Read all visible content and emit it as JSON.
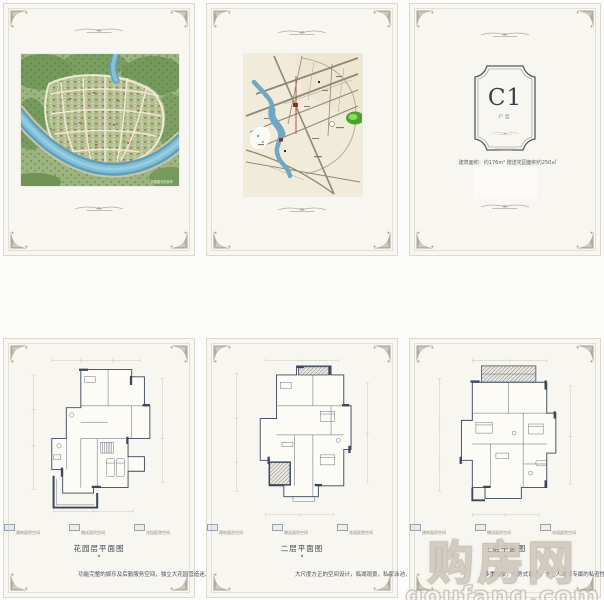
{
  "unit_card": {
    "code": "C1",
    "type_label": "户型",
    "area_info": "建筑面积：约176m² 赠送花园面积约250㎡"
  },
  "aerial": {
    "caption": "效果图仅供参考"
  },
  "plans": [
    {
      "title": "花园层平面图",
      "description": "功能完整的娱乐及后勤服务空间，独立大花园营造迷人空间。",
      "legend": [
        {
          "label": "建筑面积空间"
        },
        {
          "label": "赠送面积空间"
        },
        {
          "label": "花园庭院空间"
        }
      ]
    },
    {
      "title": "二层平面图",
      "description": "大尺度方正的空间设计，临湖观景，私家泳池，构成丰富公共活动场所。",
      "legend": [
        {
          "label": "建筑面积空间"
        },
        {
          "label": "赠送面积空间"
        },
        {
          "label": "花园庭院空间"
        }
      ]
    },
    {
      "title": "三层平面图",
      "description": "多重观景，套房式设计，令主人尽享专属的私密性和尊贵感。",
      "legend": [
        {
          "label": "建筑面积空间"
        },
        {
          "label": "赠送面积空间"
        },
        {
          "label": "花园庭院空间"
        }
      ]
    }
  ],
  "watermark": {
    "cn": "购房网",
    "en": "goufang.com"
  },
  "colors": {
    "panel_bg": "#f8f6f0",
    "frame_line": "#dcd8cc",
    "ornament_gray": "#a8a396",
    "plan_ink": "#3a4659",
    "river_blue": "#5d9fbc",
    "map_bg": "#f1ebd9",
    "park_green": "#48a238",
    "accent_red": "#b5524a",
    "watermark_fill": "#ffffff"
  }
}
